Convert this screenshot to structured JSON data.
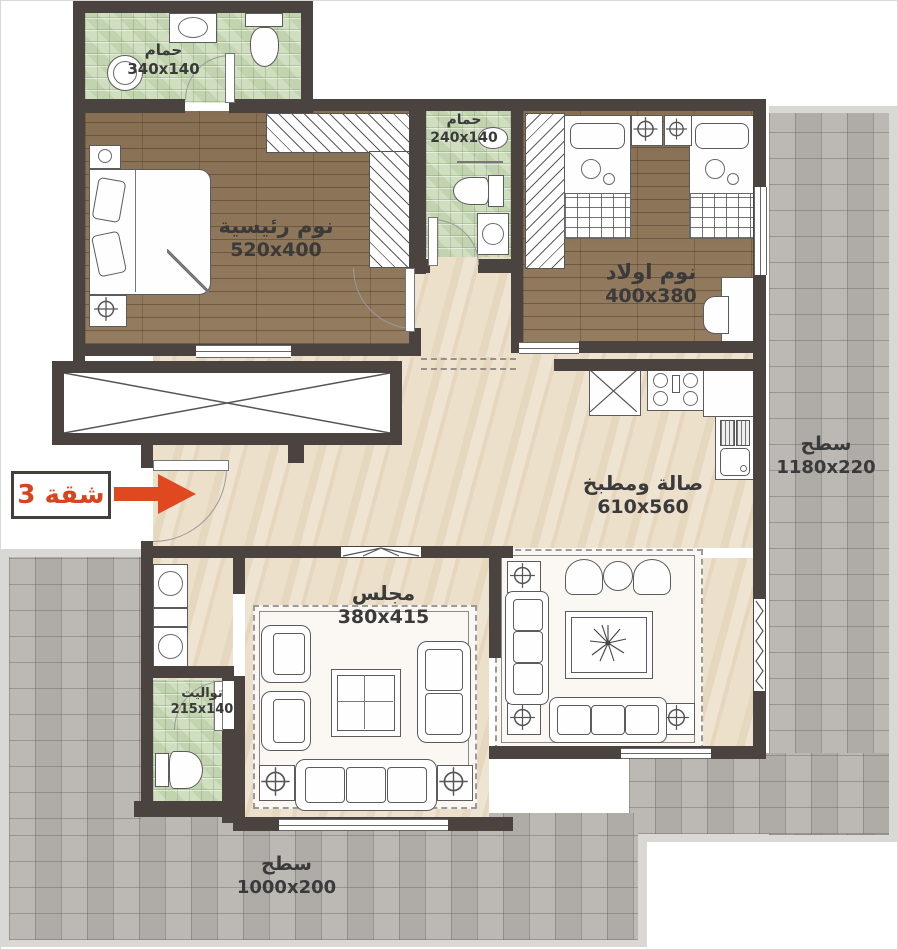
{
  "tag": {
    "label": "شقة 3"
  },
  "rooms": {
    "bathroom_top": {
      "name": "حمام",
      "dims": "340x140"
    },
    "master_bedroom": {
      "name": "نوم رئيسية",
      "dims": "520x400"
    },
    "bathroom_middle": {
      "name": "حمام",
      "dims": "240x140"
    },
    "kids_bedroom": {
      "name": "نوم اولاد",
      "dims": "400x380"
    },
    "terrace_right": {
      "name": "سطح",
      "dims": "1180x220"
    },
    "hall_kitchen": {
      "name": "صالة ومطبخ",
      "dims": "610x560"
    },
    "majlis": {
      "name": "مجلس",
      "dims": "380x415"
    },
    "toilet": {
      "name": "تواليت",
      "dims": "215x140"
    },
    "terrace_bottom": {
      "name": "سطح",
      "dims": "1000x200"
    }
  },
  "colors": {
    "wall": "#4a433f",
    "accent_red": "#dd4a1f",
    "green_tile": "#cadbb9",
    "wood": "#8e7557",
    "marble": "#ece0cb",
    "terrace": "#b8b5b0"
  }
}
